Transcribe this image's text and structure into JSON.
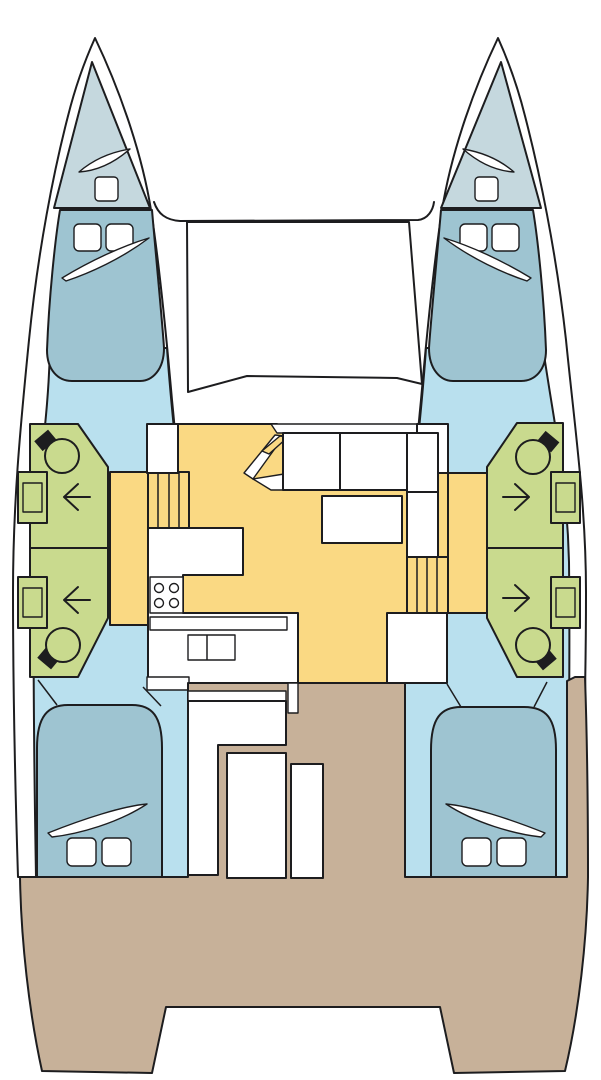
{
  "diagram": {
    "type": "boat-floorplan",
    "subject": "catamaran-interior-layout-top-view",
    "orientation": "bow-up",
    "colors": {
      "outline": "#1d1d1f",
      "hull": "#ffffff",
      "cabin_floor": "#b9e0ee",
      "berth": "#9ec4d1",
      "forepeak": "#c5d8de",
      "heads": "#c9da8e",
      "saloon": "#fad983",
      "deck": "#c7b199",
      "fixture": "#ffffff",
      "fixture_dark": "#1d1d1f"
    },
    "regions": [
      {
        "id": "port-hull",
        "name": "port hull"
      },
      {
        "id": "starboard-hull",
        "name": "starboard hull"
      },
      {
        "id": "trampoline",
        "name": "bow trampoline"
      },
      {
        "id": "port-forepeak",
        "name": "port forepeak berth"
      },
      {
        "id": "starboard-forepeak",
        "name": "starboard forepeak berth"
      },
      {
        "id": "port-forward-cabin",
        "name": "port forward double cabin"
      },
      {
        "id": "starboard-forward-cabin",
        "name": "starboard forward double cabin"
      },
      {
        "id": "port-heads-forward",
        "name": "port forward bathroom"
      },
      {
        "id": "port-heads-aft",
        "name": "port aft bathroom"
      },
      {
        "id": "starboard-heads-forward",
        "name": "starboard forward bathroom"
      },
      {
        "id": "starboard-heads-aft",
        "name": "starboard aft bathroom"
      },
      {
        "id": "saloon",
        "name": "saloon with sofa and table"
      },
      {
        "id": "galley",
        "name": "galley with stove and sink"
      },
      {
        "id": "port-companionway",
        "name": "port companionway steps"
      },
      {
        "id": "starboard-companionway",
        "name": "starboard companionway steps"
      },
      {
        "id": "port-aft-cabin",
        "name": "port aft double cabin"
      },
      {
        "id": "starboard-aft-cabin",
        "name": "starboard aft double cabin"
      },
      {
        "id": "cockpit",
        "name": "aft cockpit with table and benches"
      },
      {
        "id": "stern-platform",
        "name": "stern deck platform"
      }
    ],
    "features": {
      "double_berths": 4,
      "forepeak_berths": 2,
      "toilets": 4,
      "washbasins": 4,
      "stove_burners": 4,
      "galley_sink_bowls": 2,
      "companionway_stairs": 2,
      "direction_arrows": 4,
      "pillows": 8,
      "deck_hatches": 2
    }
  }
}
